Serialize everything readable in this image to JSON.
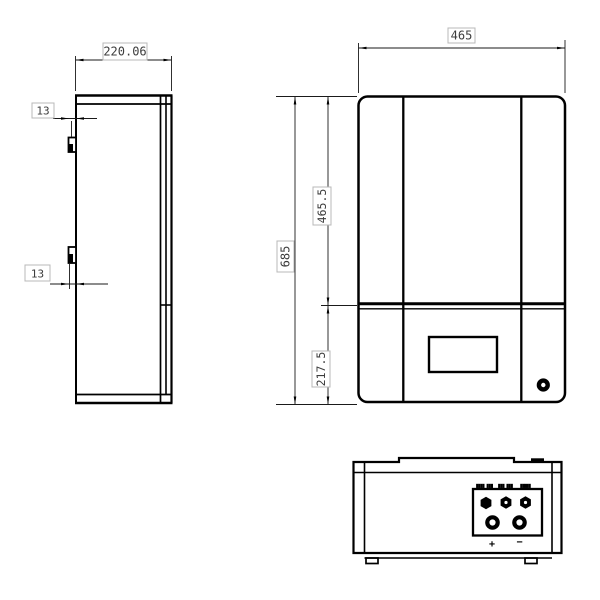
{
  "drawing": {
    "type": "three-view-engineering-drawing",
    "colors": {
      "background": "#ffffff",
      "line": "#000000",
      "dim_text": "#3c3c3c",
      "dim_box_border": "#b8b8b8"
    },
    "dimensions": {
      "side_depth": "220.06",
      "hook_offset_top": "13",
      "hook_offset_bottom": "13",
      "front_width": "465",
      "front_upper_height": "465.5",
      "front_total_height": "685",
      "front_lower_height": "217.5"
    },
    "bottom_panel": {
      "port_labels": [
        "████ ███",
        "███ ███",
        "█████"
      ],
      "positive": "+",
      "negative": "−"
    }
  }
}
